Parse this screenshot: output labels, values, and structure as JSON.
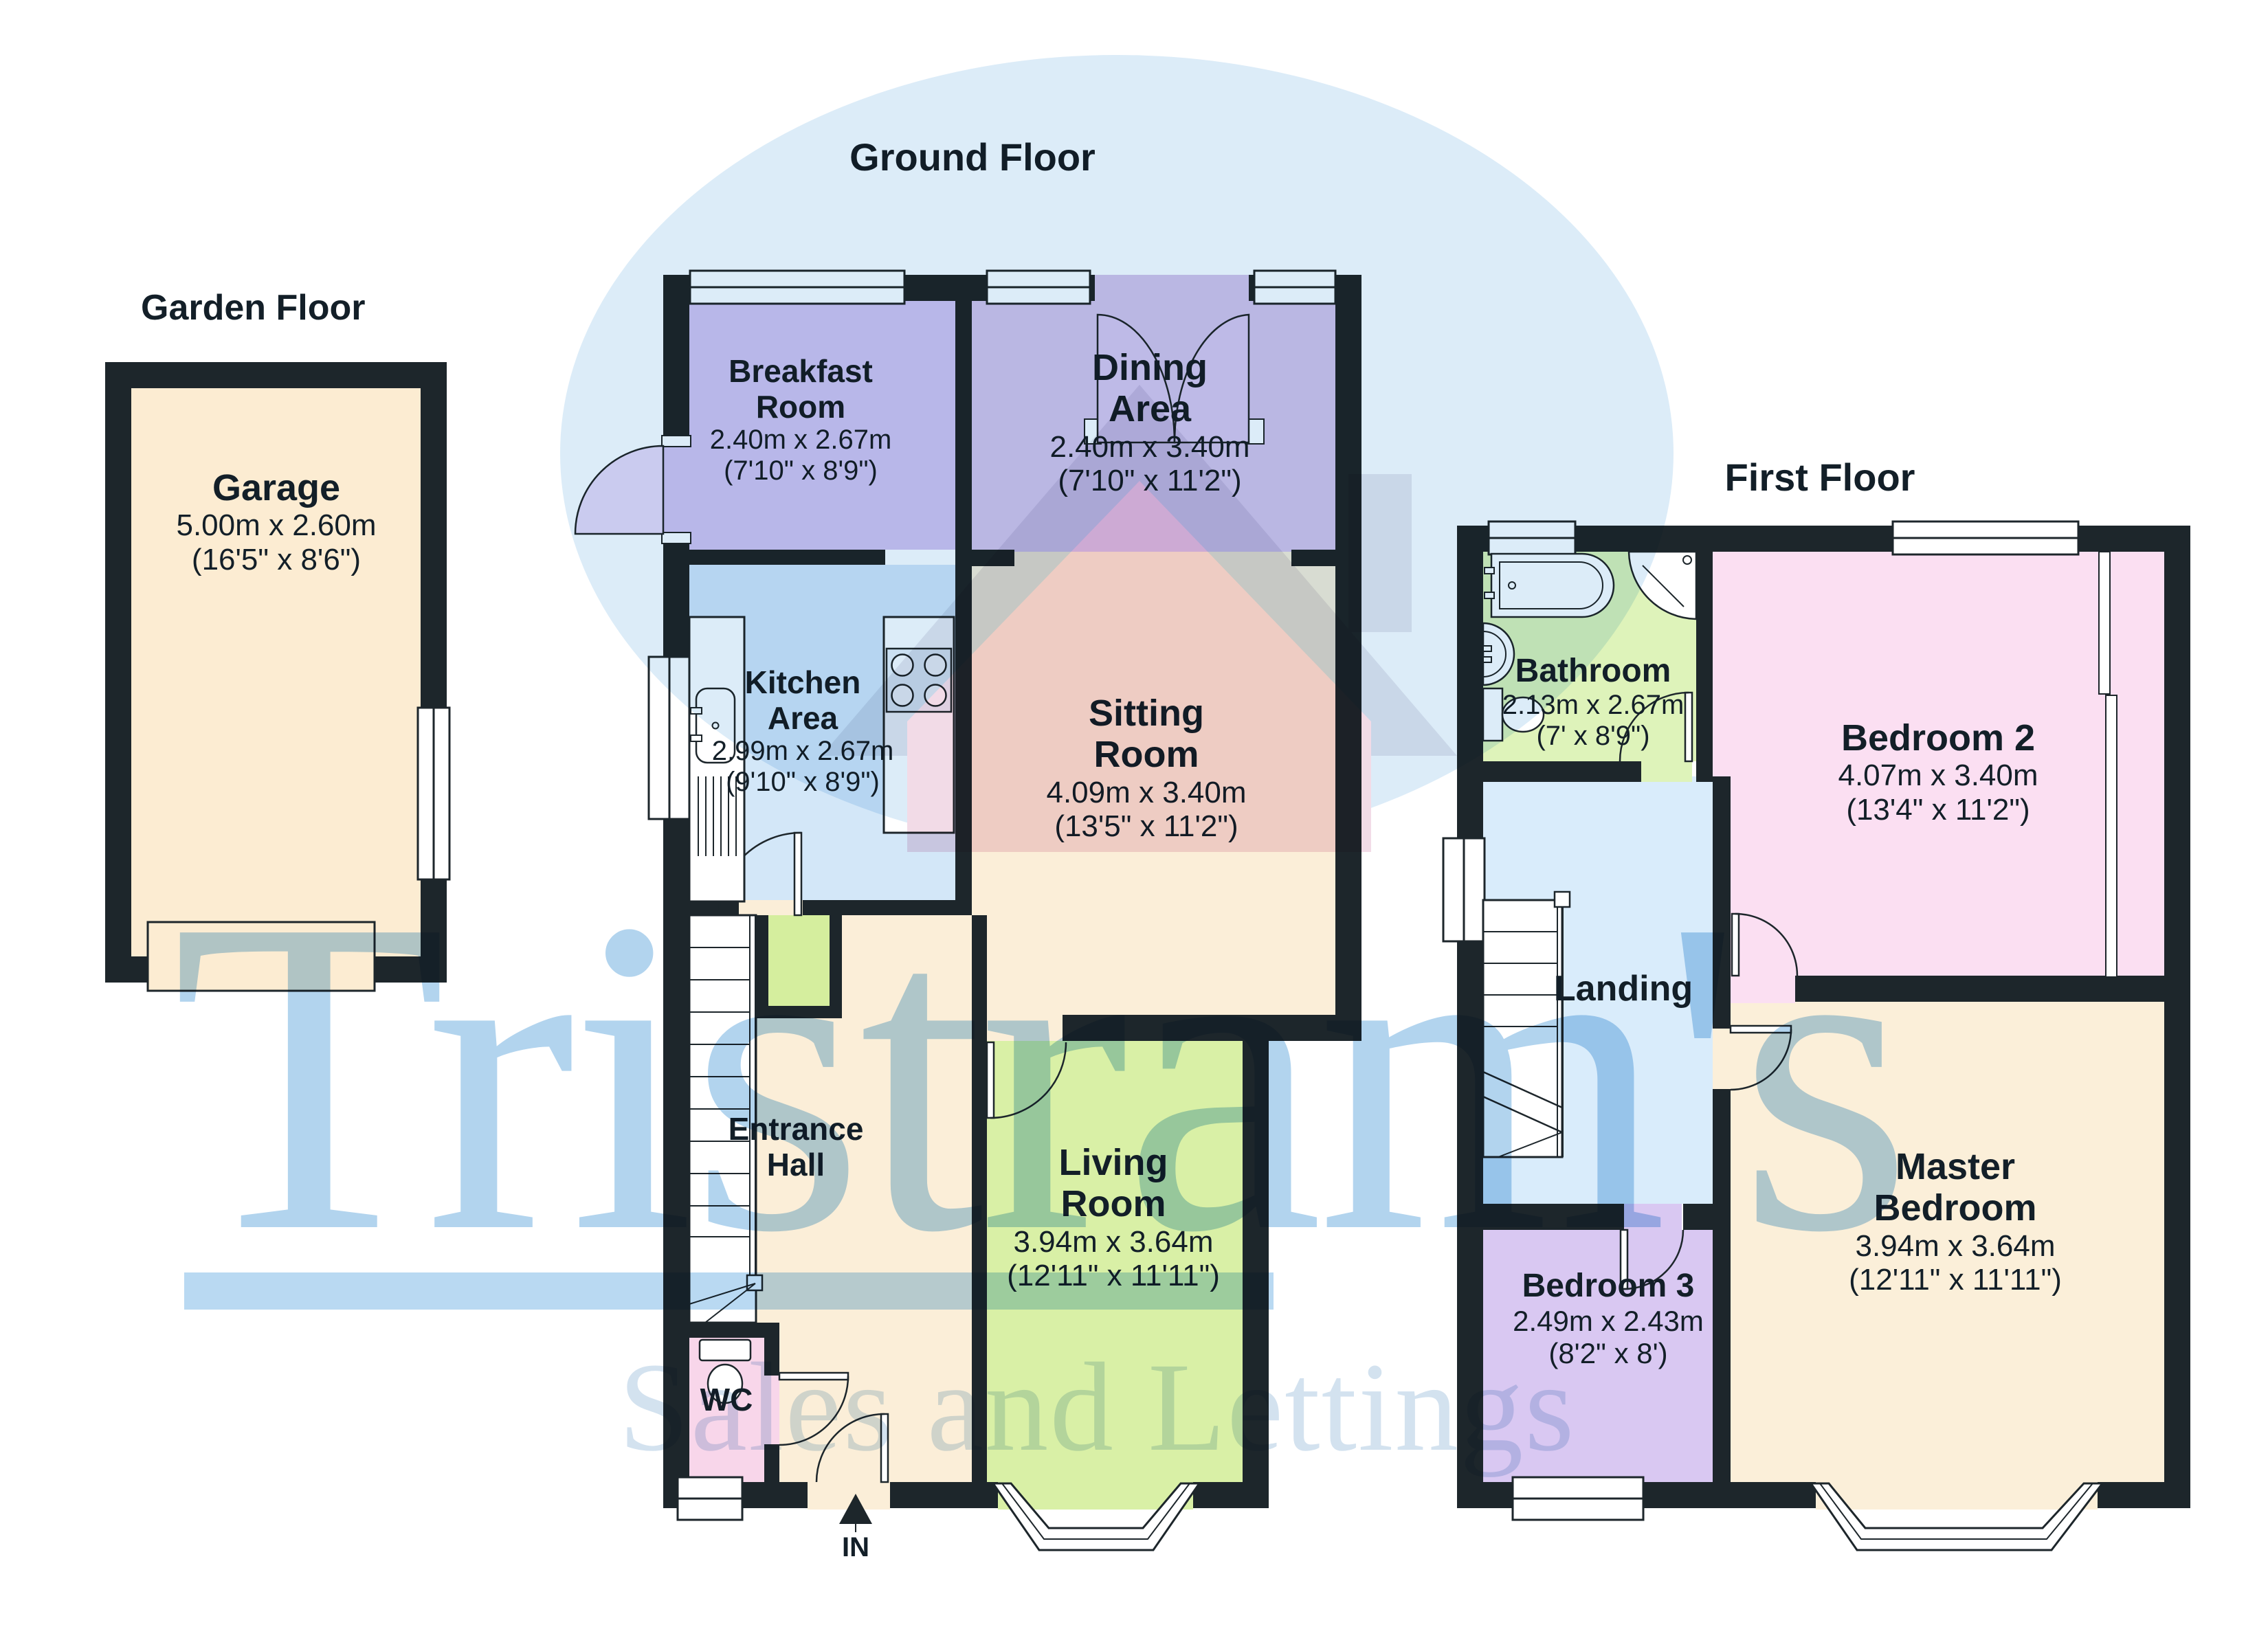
{
  "floors": {
    "garden": "Garden Floor",
    "ground": "Ground Floor",
    "first": "First Floor"
  },
  "entry_label": "IN",
  "watermark": {
    "brand": "Tristram's",
    "tagline": "Sales and Lettings",
    "brand_color": "#b2d4ee",
    "tagline_color": "#d3e2ef",
    "circle_color": "#dcecf8",
    "house_color": "#c9d7e8",
    "house_accent_color": "#f2dbe7"
  },
  "palette": {
    "wall": "#1d262b",
    "garage": "#fcecd2",
    "breakfast": "#d6c6f0",
    "dining": "#d8c6ea",
    "kitchen": "#d3e7f8",
    "sitting": "#fbeed8",
    "hall": "#fbeed8",
    "living": "#d9f0a6",
    "wc": "#f8d6ea",
    "closet": "#d5ee9e",
    "bathroom": "#def3ba",
    "bedroom2": "#fbdff2",
    "landing": "#d9ecfb",
    "master": "#fbefd9",
    "bedroom3": "#d9c8f2"
  },
  "rooms": {
    "garage": {
      "name": "Garage",
      "metric": "5.00m x 2.60m",
      "imperial": "(16'5\" x 8'6\")"
    },
    "breakfast": {
      "line1": "Breakfast",
      "line2": "Room",
      "metric": "2.40m x 2.67m",
      "imperial": "(7'10\" x 8'9\")"
    },
    "dining": {
      "line1": "Dining",
      "line2": "Area",
      "metric": "2.40m x 3.40m",
      "imperial": "(7'10\" x 11'2\")"
    },
    "kitchen": {
      "line1": "Kitchen",
      "line2": "Area",
      "metric": "2.99m x 2.67m",
      "imperial": "(9'10\" x 8'9\")"
    },
    "sitting": {
      "line1": "Sitting",
      "line2": "Room",
      "metric": "4.09m x 3.40m",
      "imperial": "(13'5\" x 11'2\")"
    },
    "entrance": {
      "line1": "Entrance",
      "line2": "Hall"
    },
    "living": {
      "line1": "Living",
      "line2": "Room",
      "metric": "3.94m x 3.64m",
      "imperial": "(12'11\" x 11'11\")"
    },
    "wc": {
      "name": "WC"
    },
    "bathroom": {
      "name": "Bathroom",
      "metric": "2.13m x 2.67m",
      "imperial": "(7' x 8'9\")"
    },
    "bedroom2": {
      "name": "Bedroom 2",
      "metric": "4.07m x 3.40m",
      "imperial": "(13'4\" x 11'2\")"
    },
    "landing": {
      "name": "Landing"
    },
    "master": {
      "line1": "Master",
      "line2": "Bedroom",
      "metric": "3.94m x 3.64m",
      "imperial": "(12'11\" x 11'11\")"
    },
    "bedroom3": {
      "name": "Bedroom 3",
      "metric": "2.49m x 2.43m",
      "imperial": "(8'2\" x 8')"
    }
  }
}
